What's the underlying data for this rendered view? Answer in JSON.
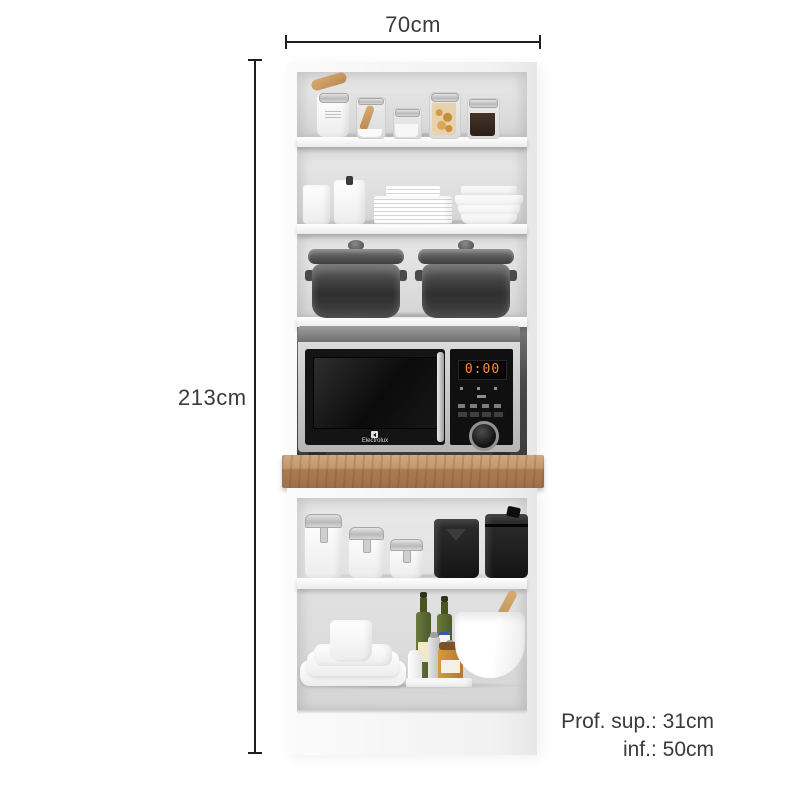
{
  "annotations": {
    "width_label": "70cm",
    "height_label": "213cm",
    "depth_top_label": "Prof. sup.: 31cm",
    "depth_bottom_label": "inf.: 50cm"
  },
  "microwave": {
    "display_time": "0:00",
    "brand": "Electrolux"
  },
  "colors": {
    "annotation_text": "#3a3a3a",
    "dimension_line": "#1f1f1f",
    "cabinet_white": "#f7f7f7",
    "shelf_interior": "#dedede",
    "microwave_niche": "#474747",
    "countertop_wood": "#a5754e",
    "microwave_silver": "#c9c9c9",
    "microwave_door": "#141414",
    "display_digit_color": "#ff8c3c"
  }
}
